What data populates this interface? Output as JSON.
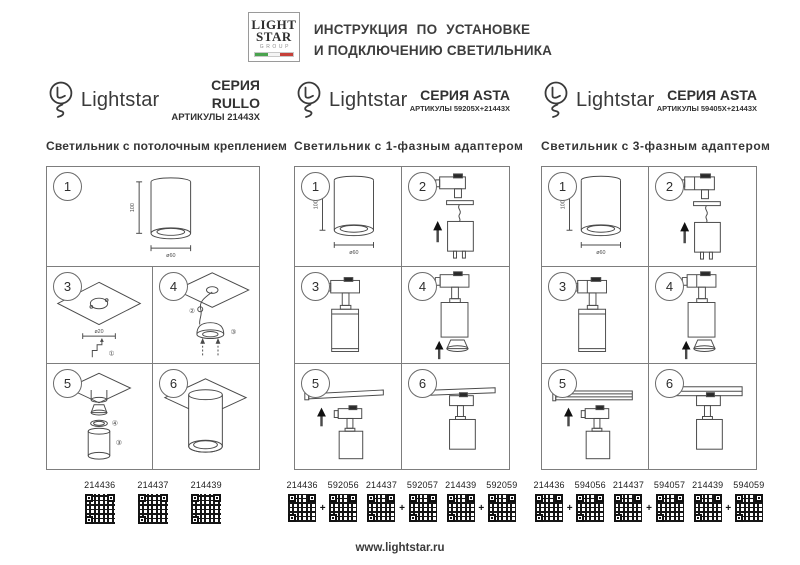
{
  "header": {
    "logo": {
      "line1": "LIGHT",
      "line2": "STAR",
      "line3": "GROUP"
    },
    "title_line1": "ИНСТРУКЦИЯ ПО УСТАНОВКЕ",
    "title_line2": "И ПОДКЛЮЧЕНИЮ СВЕТИЛЬНИКА"
  },
  "shared": {
    "brand": "Lightstar",
    "steps": {
      "s1": "1",
      "s2": "2",
      "s3": "3",
      "s4": "4",
      "s5": "5",
      "s6": "6"
    },
    "dims": {
      "height": "100",
      "diameter": "ø60",
      "hole": "ø20"
    },
    "callouts": {
      "c1": "①",
      "c2": "②",
      "c3": "③",
      "c4": "④"
    },
    "plus": "+"
  },
  "columns": [
    {
      "series": "СЕРИЯ RULLO",
      "articles": "АРТИКУЛЫ 21443X",
      "subtitle": "Светильник с потолочным креплением",
      "codes": [
        "214436",
        "214437",
        "214439"
      ]
    },
    {
      "series": "СЕРИЯ ASTA",
      "articles": "АРТИКУЛЫ 59205X+21443X",
      "subtitle": "Светильник с 1-фазным адаптером",
      "pairs": [
        [
          "214436",
          "592056"
        ],
        [
          "214437",
          "592057"
        ],
        [
          "214439",
          "592059"
        ]
      ]
    },
    {
      "series": "СЕРИЯ ASTA",
      "articles": "АРТИКУЛЫ 59405X+21443X",
      "subtitle": "Светильник с 3-фазным адаптером",
      "pairs": [
        [
          "214436",
          "594056"
        ],
        [
          "214437",
          "594057"
        ],
        [
          "214439",
          "594059"
        ]
      ]
    }
  ],
  "footer": {
    "url": "www.lightstar.ru"
  },
  "colors": {
    "accent_green": "#4aa34e",
    "accent_red": "#c64039",
    "ink": "#3a3a3a"
  }
}
